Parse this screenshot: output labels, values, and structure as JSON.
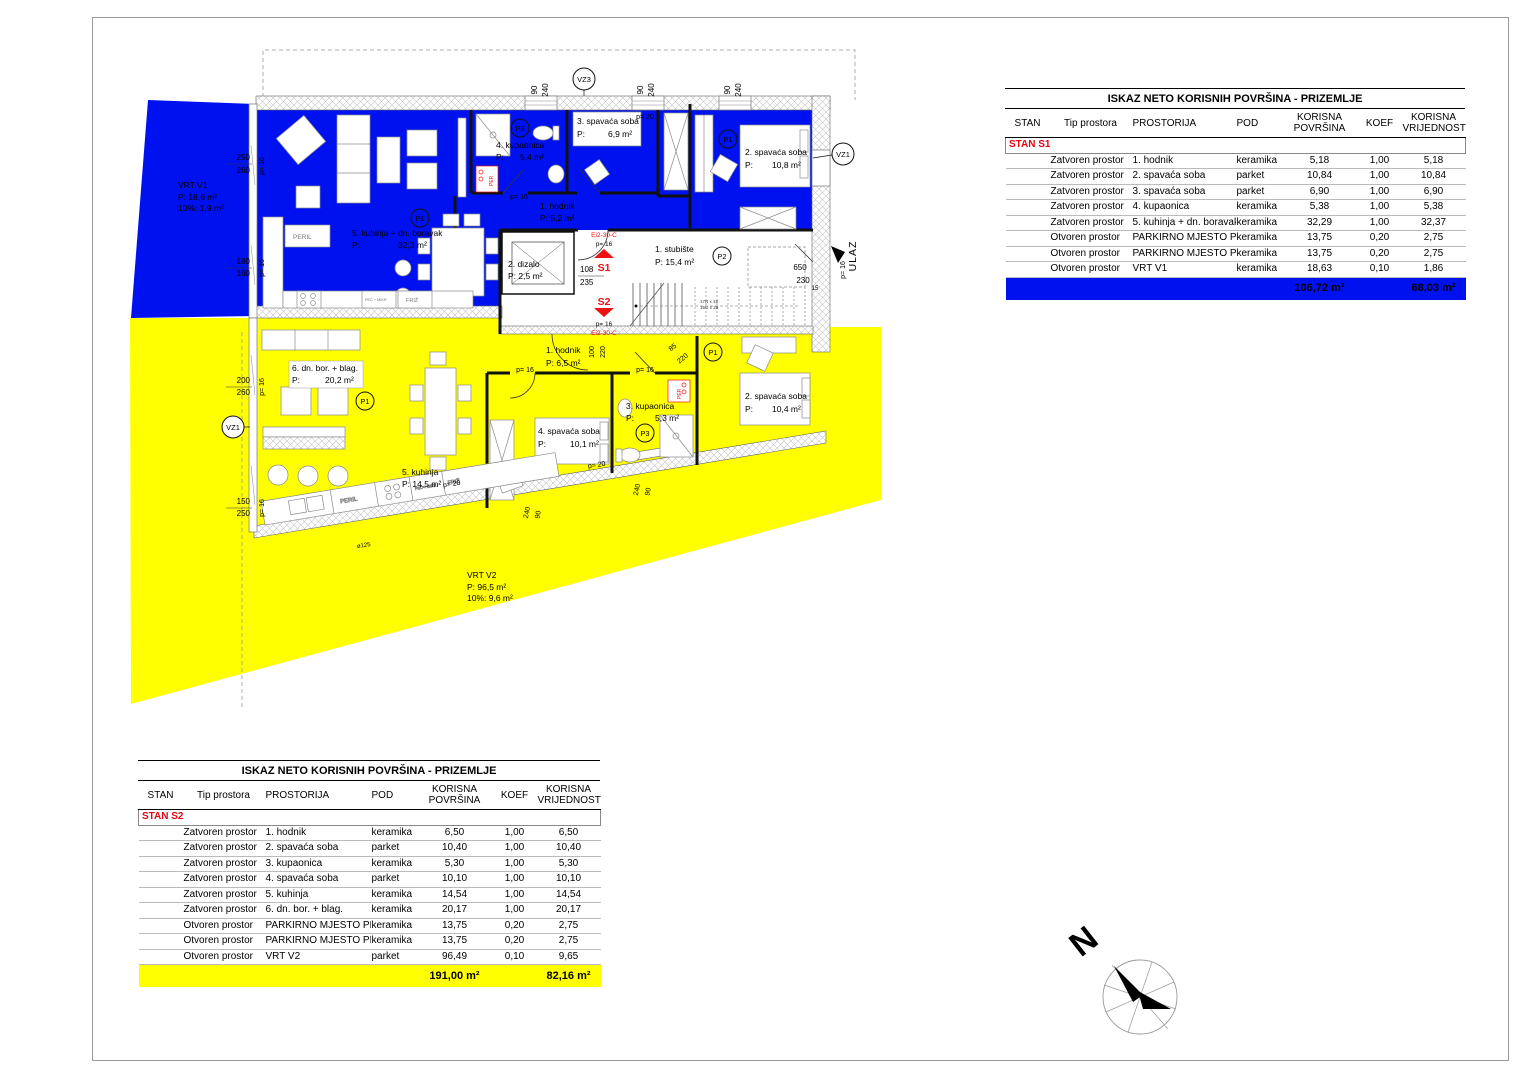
{
  "colors": {
    "s1_blue": "#0011f0",
    "s2_yellow": "#ffff00",
    "marker_red": "#ee1111"
  },
  "tables": {
    "s1": {
      "title": "ISKAZ NETO KORISNIH POVRŠINA - PRIZEMLJE",
      "columns": [
        "STAN",
        "Tip prostora",
        "PROSTORIJA",
        "POD",
        "KORISNA POVRŠINA",
        "KOEF",
        "KORISNA VRIJEDNOST"
      ],
      "group": "STAN S1",
      "rows": [
        {
          "tip": "Zatvoren prostor",
          "prostorija": "1. hodnik",
          "pod": "keramika",
          "povrsina": "5,18",
          "koef": "1,00",
          "vrijednost": "5,18"
        },
        {
          "tip": "Zatvoren prostor",
          "prostorija": "2. spavaća soba",
          "pod": "parket",
          "povrsina": "10,84",
          "koef": "1,00",
          "vrijednost": "10,84"
        },
        {
          "tip": "Zatvoren prostor",
          "prostorija": "3. spavaća soba",
          "pod": "parket",
          "povrsina": "6,90",
          "koef": "1,00",
          "vrijednost": "6,90"
        },
        {
          "tip": "Zatvoren prostor",
          "prostorija": "4. kupaonica",
          "pod": "keramika",
          "povrsina": "5,38",
          "koef": "1,00",
          "vrijednost": "5,38"
        },
        {
          "tip": "Zatvoren prostor",
          "prostorija": "5. kuhinja + dn. boravak",
          "pod": "keramika",
          "povrsina": "32,29",
          "koef": "1,00",
          "vrijednost": "32,37"
        },
        {
          "tip": "Otvoren prostor",
          "prostorija": "PARKIRNO MJESTO PM1",
          "pod": "keramika",
          "povrsina": "13,75",
          "koef": "0,20",
          "vrijednost": "2,75"
        },
        {
          "tip": "Otvoren prostor",
          "prostorija": "PARKIRNO MJESTO PM2",
          "pod": "keramika",
          "povrsina": "13,75",
          "koef": "0,20",
          "vrijednost": "2,75"
        },
        {
          "tip": "Otvoren prostor",
          "prostorija": "VRT V1",
          "pod": "keramika",
          "povrsina": "18,63",
          "koef": "0,10",
          "vrijednost": "1,86"
        }
      ],
      "total_povrsina": "106,72 m²",
      "total_vrijednost": "68,03 m²"
    },
    "s2": {
      "title": "ISKAZ NETO KORISNIH POVRŠINA - PRIZEMLJE",
      "columns": [
        "STAN",
        "Tip prostora",
        "PROSTORIJA",
        "POD",
        "KORISNA POVRŠINA",
        "KOEF",
        "KORISNA VRIJEDNOST"
      ],
      "group": "STAN S2",
      "rows": [
        {
          "tip": "Zatvoren prostor",
          "prostorija": "1. hodnik",
          "pod": "keramika",
          "povrsina": "6,50",
          "koef": "1,00",
          "vrijednost": "6,50"
        },
        {
          "tip": "Zatvoren prostor",
          "prostorija": "2. spavaća soba",
          "pod": "parket",
          "povrsina": "10,40",
          "koef": "1,00",
          "vrijednost": "10,40"
        },
        {
          "tip": "Zatvoren prostor",
          "prostorija": "3. kupaonica",
          "pod": "keramika",
          "povrsina": "5,30",
          "koef": "1,00",
          "vrijednost": "5,30"
        },
        {
          "tip": "Zatvoren prostor",
          "prostorija": "4. spavaća soba",
          "pod": "parket",
          "povrsina": "10,10",
          "koef": "1,00",
          "vrijednost": "10,10"
        },
        {
          "tip": "Zatvoren prostor",
          "prostorija": "5. kuhinja",
          "pod": "keramika",
          "povrsina": "14,54",
          "koef": "1,00",
          "vrijednost": "14,54"
        },
        {
          "tip": "Zatvoren prostor",
          "prostorija": "6. dn. bor. + blag.",
          "pod": "keramika",
          "povrsina": "20,17",
          "koef": "1,00",
          "vrijednost": "20,17"
        },
        {
          "tip": "Otvoren prostor",
          "prostorija": "PARKIRNO MJESTO PM3",
          "pod": "keramika",
          "povrsina": "13,75",
          "koef": "0,20",
          "vrijednost": "2,75"
        },
        {
          "tip": "Otvoren prostor",
          "prostorija": "PARKIRNO MJESTO PM4",
          "pod": "keramika",
          "povrsina": "13,75",
          "koef": "0,20",
          "vrijednost": "2,75"
        },
        {
          "tip": "Otvoren prostor",
          "prostorija": "VRT V2",
          "pod": "parket",
          "povrsina": "96,49",
          "koef": "0,10",
          "vrijednost": "9,65"
        }
      ],
      "total_povrsina": "191,00 m²",
      "total_vrijednost": "82,16 m²"
    }
  },
  "plan": {
    "rooms": {
      "s1_kitchen": {
        "name": "5. kuhinja + dn. boravak",
        "p": "P:",
        "area": "32,3 m²"
      },
      "s1_hall": {
        "name": "1. hodnik",
        "area": "P: 5,2 m²"
      },
      "s1_bath": {
        "name": "4. kupaonica",
        "p": "P:",
        "area": "5,4 m²"
      },
      "s1_bed3": {
        "name": "3. spavaća soba",
        "p": "P:",
        "area": "6,9 m²"
      },
      "s1_bed2": {
        "name": "2. spavaća soba",
        "p": "P:",
        "area": "10,8 m²"
      },
      "lift": {
        "name": "2. dizalo",
        "area": "P: 2,5 m²"
      },
      "stair": {
        "name": "1. stubište",
        "area": "P: 15,4 m²"
      },
      "s2_hall": {
        "name": "1. hodnik",
        "area": "P: 6,5 m²"
      },
      "s2_living": {
        "name": "6. dn. bor. + blag.",
        "p": "P:",
        "area": "20,2 m²"
      },
      "s2_kitchen": {
        "name": "5. kuhinja",
        "area": "P: 14,5 m²"
      },
      "s2_bed4": {
        "name": "4. spavaća soba",
        "p": "P:",
        "area": "10,1 m²"
      },
      "s2_bath": {
        "name": "3. kupaonica",
        "p": "P:",
        "area": "5,3 m²"
      },
      "s2_bed2": {
        "name": "2. spavaća soba",
        "p": "P:",
        "area": "10,4 m²"
      }
    },
    "gardens": {
      "vrt1": {
        "name": "VRT V1",
        "area": "P:    18,6 m²",
        "pct": "10%: 1,9 m²"
      },
      "vrt2": {
        "name": "VRT V2",
        "area": "P:    96,5 m²",
        "pct": "10%: 9,6 m²"
      }
    },
    "markers": {
      "p1": "P1",
      "p2": "P2",
      "p3": "P3",
      "vz1": "VZ1",
      "vz3": "VZ3",
      "s1": "S1",
      "s2": "S2",
      "fire_rating": "Ei2-30-C",
      "entry": "ULAZ"
    },
    "appliances": {
      "peril": "PERIL",
      "pec_mikr": "PEĆ + MIKR",
      "friz": "FRIŽ",
      "per": "PER"
    },
    "stairs": {
      "note_top": "17R x 18",
      "note_bottom": "16G x 28"
    },
    "dims": {
      "d90": "90",
      "d240": "240",
      "d250": "250",
      "d260": "260",
      "d180": "180",
      "d160": "160",
      "d200": "200",
      "d150": "150",
      "d108": "108",
      "d235": "235",
      "d100": "100",
      "d220": "220",
      "d85": "85",
      "d650": "650",
      "d230": "230",
      "d15": "15",
      "p16": "p= 16",
      "p20": "p= 20",
      "fi125": "ø125"
    }
  },
  "compass": {
    "north": "N"
  }
}
